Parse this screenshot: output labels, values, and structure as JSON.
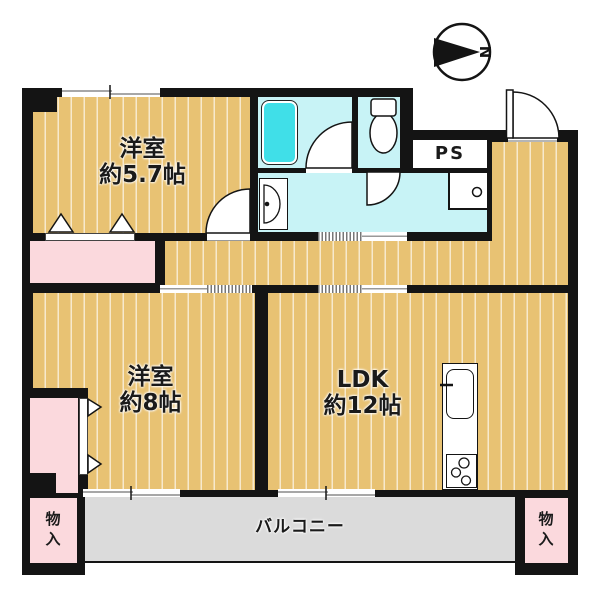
{
  "compass": {
    "label": "N"
  },
  "rooms": {
    "bedroom_small": {
      "name": "洋室",
      "size": "約5.7帖"
    },
    "bedroom_large": {
      "name": "洋室",
      "size": "約8帖"
    },
    "ldk": {
      "name": "LDK",
      "size": "約12帖"
    },
    "pipe_space": {
      "label": "PS"
    },
    "balcony": {
      "label": "バルコニー"
    },
    "storage_left": {
      "label": "物入"
    },
    "storage_right": {
      "label": "物入"
    }
  },
  "colors": {
    "wall": "#141414",
    "floor": "#e8c273",
    "floor_stripe": "#f7e9cd",
    "wet_room": "#c8f3f6",
    "bathtub": "#40dfe8",
    "closet_pink": "#fbd9dd",
    "balcony_gray": "#dbdbdb",
    "line_gray": "#8a8a8a",
    "text": "#1a1a1a"
  }
}
